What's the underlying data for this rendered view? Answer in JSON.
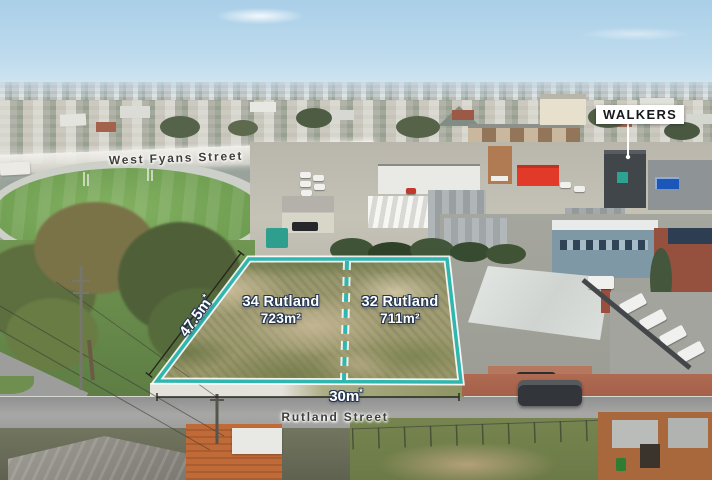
{
  "scene": {
    "type": "aerial-photo-of-land-for-sale",
    "accent_teal": "#2fb7af",
    "label_outline_navy": "#253652",
    "street_label_color": "#3f3e3a"
  },
  "agency_sign": {
    "label": "WALKERS",
    "bg": "#ffffff",
    "text_color": "#17191d"
  },
  "streets": {
    "west_fyans": {
      "label": "West Fyans Street"
    },
    "rutland": {
      "label": "Rutland Street"
    }
  },
  "lots": [
    {
      "name": "34 Rutland",
      "area": "723m²"
    },
    {
      "name": "32 Rutland",
      "area": "711m²"
    }
  ],
  "dimensions": {
    "frontage_left": {
      "value": "47.5m",
      "mark": "*"
    },
    "frontage_bottom": {
      "value": "30m",
      "mark": "*"
    }
  }
}
